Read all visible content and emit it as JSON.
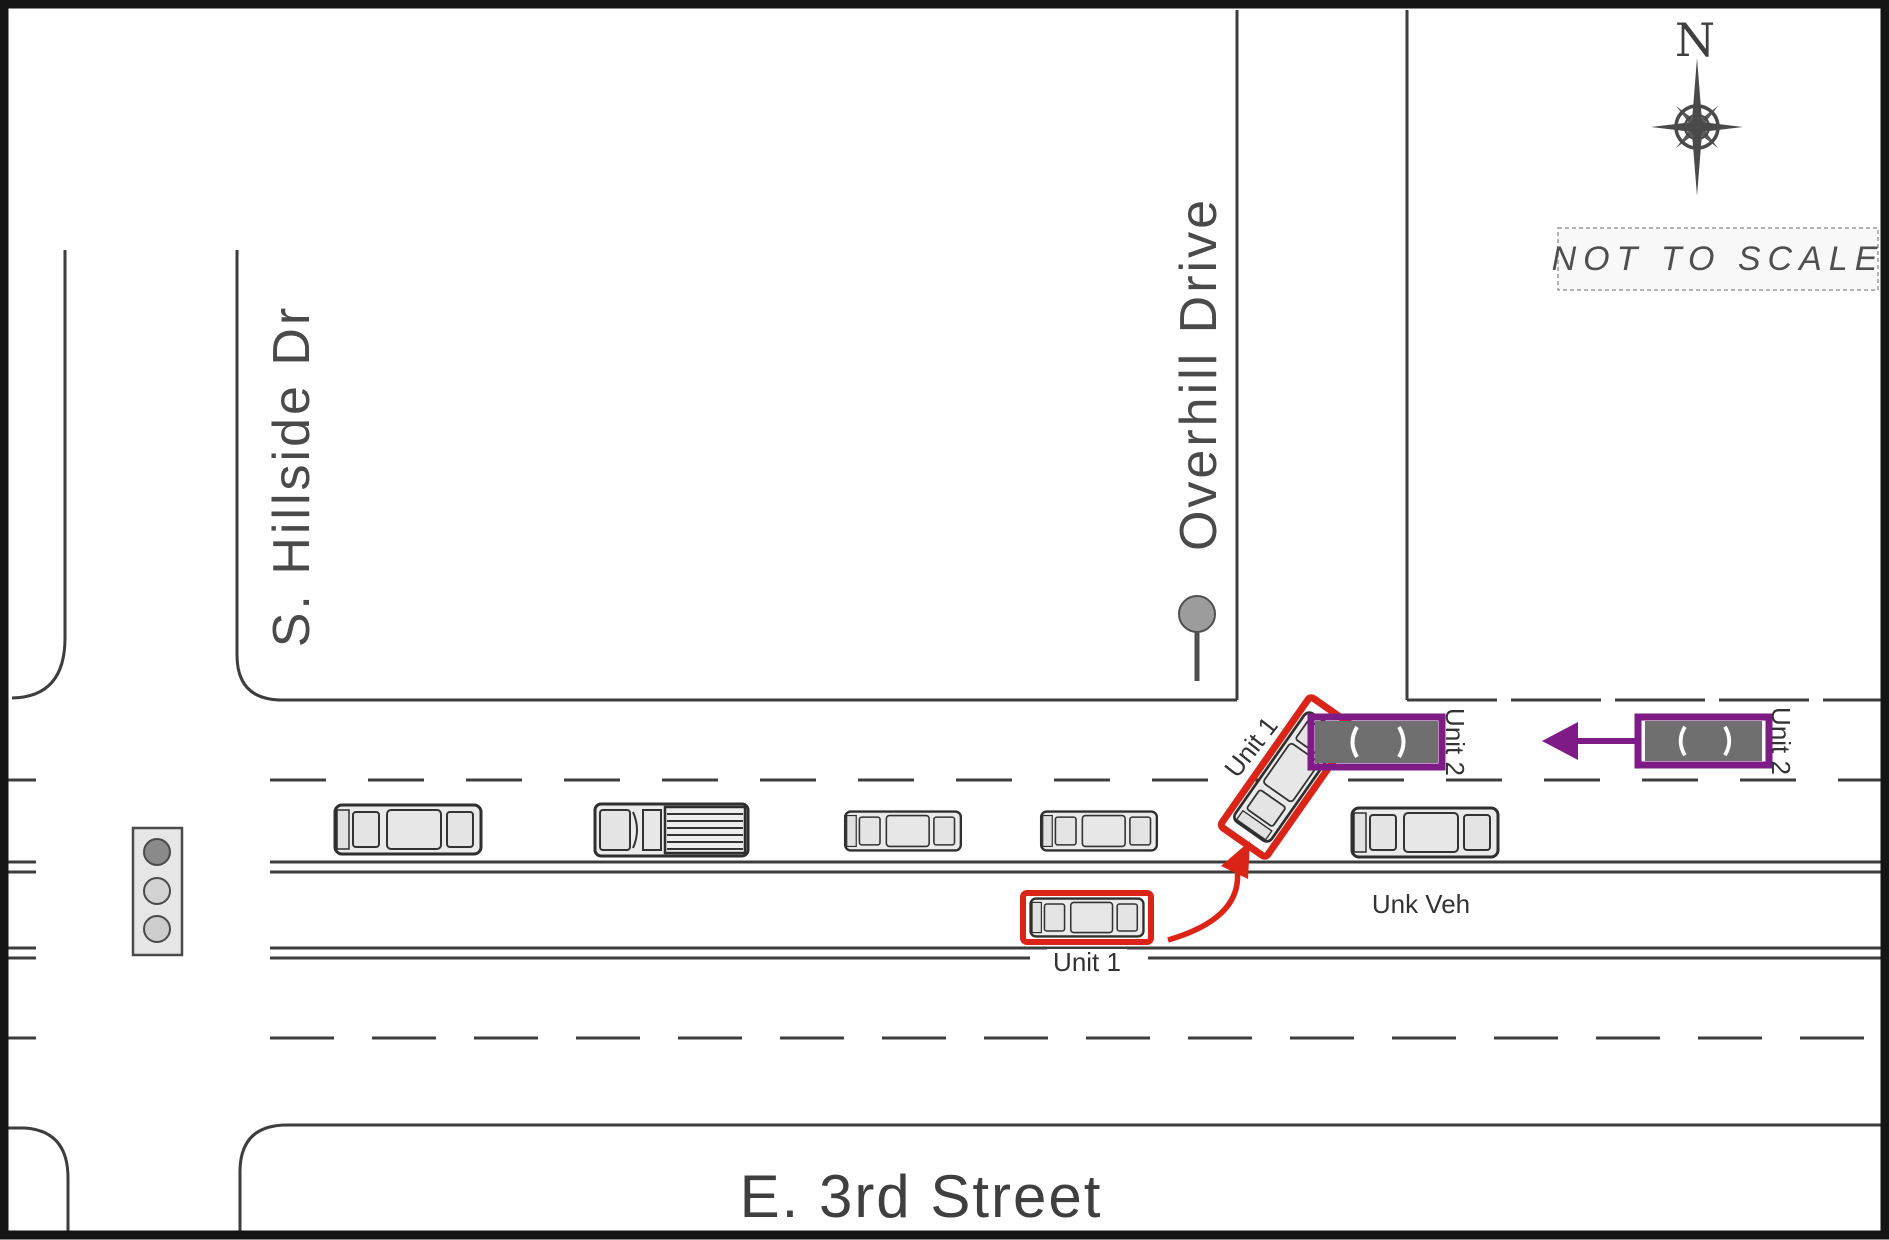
{
  "meta": {
    "scale_note": "NOT TO SCALE",
    "compass_label": "N"
  },
  "streets": {
    "vertical_left": "S. Hillside Dr",
    "vertical_right": "Overhill Drive",
    "horizontal_bottom": "E. 3rd Street"
  },
  "vehicles": {
    "unit1_pre_impact_label": "Unit 1",
    "unit1_impact_label": "Unit 1",
    "unit2_impact_label": "Unit 2",
    "unit2_pre_impact_label": "Unit 2",
    "unknown_vehicle_label": "Unk Veh"
  },
  "colors": {
    "unit1_red": "#da2418",
    "unit2_purple": "#7e1b87",
    "road_line_gray": "#3d3d3d",
    "vehicle_fill": "#ebebeb",
    "dark_vehicle_fill": "#6f6f6f",
    "frame_black": "#151515"
  }
}
